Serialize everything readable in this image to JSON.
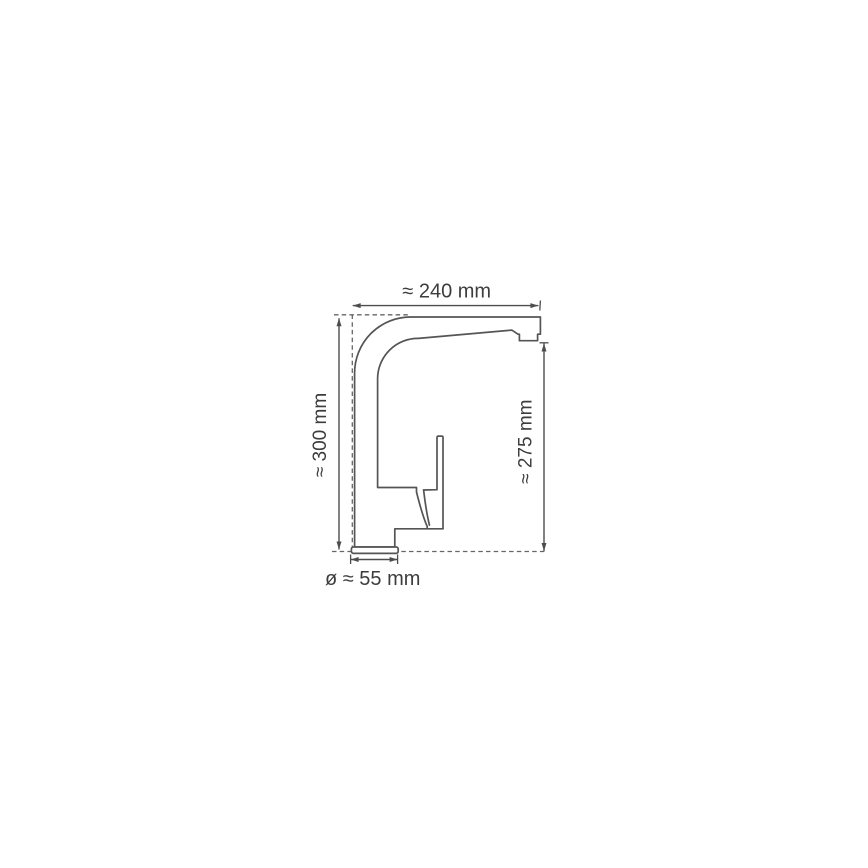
{
  "page": {
    "background_color": "#ffffff",
    "line_color": "#555555",
    "dimension_color": "#4d4d4d",
    "text_color": "#3d3d3d"
  },
  "diagram": {
    "type": "technical-drawing",
    "subject": "single-lever kitchen faucet, side elevation with dimension lines",
    "labels": {
      "top": "≈ 240 mm",
      "left": "≈ 300 mm",
      "right": "≈ 275 mm",
      "bottom": "ø ≈ 55 mm"
    },
    "dimensions": [
      {
        "position": "top",
        "label": "≈ 240 mm",
        "value": 240,
        "unit": "mm",
        "approx": true
      },
      {
        "position": "left",
        "label": "≈ 300 mm",
        "value": 300,
        "unit": "mm",
        "approx": true
      },
      {
        "position": "right",
        "label": "≈ 275 mm",
        "value": 275,
        "unit": "mm",
        "approx": true
      },
      {
        "position": "bottom",
        "label": "ø ≈ 55 mm",
        "value": 55,
        "unit": "mm",
        "approx": true,
        "is_diameter": true
      }
    ]
  }
}
